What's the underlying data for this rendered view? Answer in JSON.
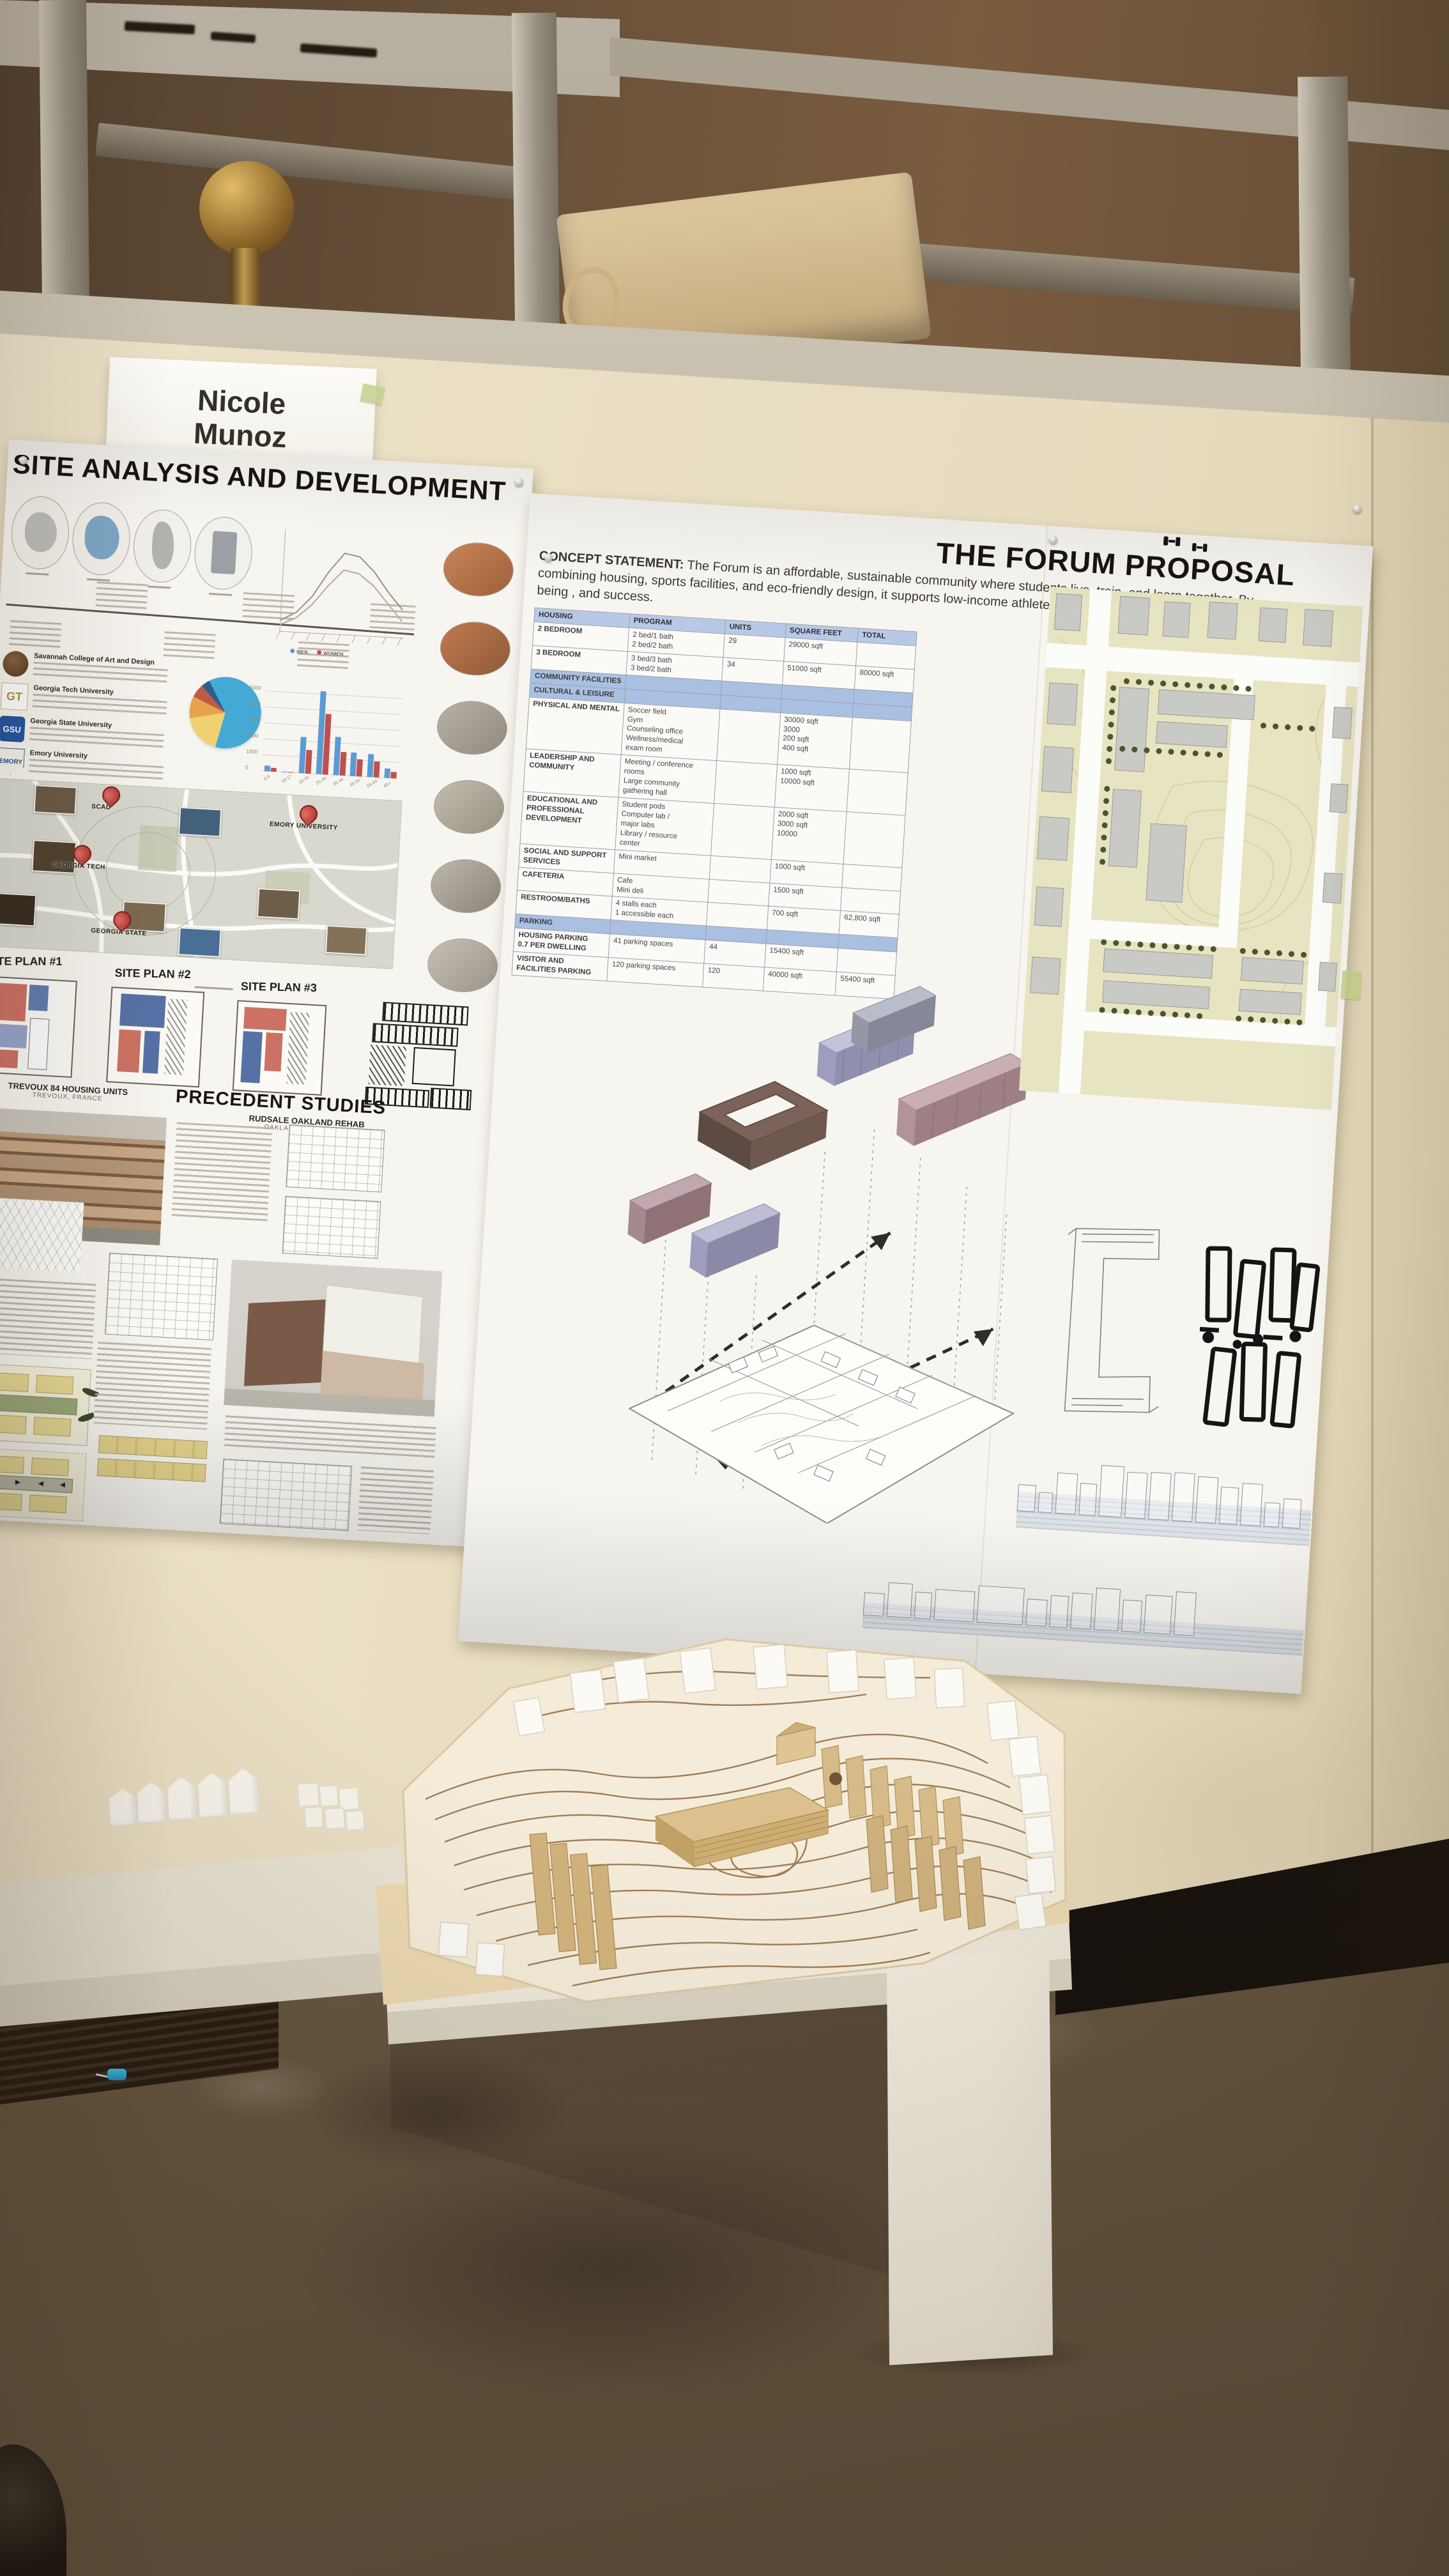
{
  "scene": {
    "name_card": {
      "name": "Nicole\nMunoz"
    }
  },
  "poster_left": {
    "title": "SITE ANALYSIS AND DEVELOPMENT",
    "universities": [
      {
        "abbr": "SCAD",
        "name": "Savannah College of Art and Design"
      },
      {
        "abbr": "GT",
        "name": "Georgia Tech University"
      },
      {
        "abbr": "GSU",
        "name": "Georgia State University"
      },
      {
        "abbr": "EMORY",
        "name": "Emory University"
      }
    ],
    "map_pins": [
      "SCAD",
      "GEORGIA TECH",
      "GEORGIA STATE",
      "EMORY UNIVERSITY"
    ],
    "sketch_labels": [
      "SITE PLAN #1",
      "SITE PLAN #2",
      "SITE PLAN #3"
    ],
    "precedent": {
      "heading": "PRECEDENT STUDIES",
      "study1": {
        "title": "TREVOUX 84 HOUSING UNITS",
        "subtitle": "TREVOUX, FRANCE"
      },
      "study2": {
        "title": "RUDSALE OAKLAND REHAB",
        "subtitle": "OAKLAND, CALIFORNIA"
      }
    }
  },
  "poster_right": {
    "title": "THE FORUM PROPOSAL",
    "concept_label": "CONCEPT STATEMENT:",
    "concept_text": "The Forum is an affordable, sustainable community where students live, train, and learn together. By combining housing, sports facilities, and eco-friendly design, it supports low-income athletes while fostering collaboration, well-being , and success.",
    "table": {
      "headers": [
        "HOUSING",
        "PROGRAM",
        "UNITS",
        "SQUARE FEET",
        "TOTAL"
      ],
      "rows": [
        {
          "cells": [
            "2 BEDROOM",
            "2 bed/1 bath\n2 bed/2 bath",
            "29",
            "29000 sqft",
            ""
          ]
        },
        {
          "cells": [
            "3 BEDROOM",
            "3 bed/3 bath\n3 bed/2 bath",
            "34",
            "51000 sqft",
            "80000 sqft"
          ]
        },
        {
          "kind": "section",
          "cells": [
            "COMMUNITY FACILITIES",
            "",
            "",
            "",
            ""
          ]
        },
        {
          "kind": "section",
          "cells": [
            "CULTURAL & LEISURE",
            "",
            "",
            "",
            ""
          ]
        },
        {
          "cells": [
            "PHYSICAL AND MENTAL",
            "Soccer field\nGym\nCounseling office\nWellness/medical\nexam room",
            "",
            "30000 sqft\n3000\n200 sqft\n400 sqft",
            ""
          ]
        },
        {
          "cells": [
            "LEADERSHIP AND COMMUNITY",
            "Meeting / conference\nrooms\nLarge community\ngathering hall",
            "",
            "1000 sqft\n10000 sqft",
            ""
          ]
        },
        {
          "cells": [
            "EDUCATIONAL AND PROFESSIONAL DEVELOPMENT",
            "Student pods\nComputer lab /\nmajor labs\nLibrary / resource\ncenter",
            "",
            "2000 sqft\n3000 sqft\n10000",
            ""
          ]
        },
        {
          "cells": [
            "SOCIAL AND SUPPORT SERVICES",
            "Mini market",
            "",
            "1000 sqft",
            ""
          ]
        },
        {
          "cells": [
            "CAFETERIA",
            "Cafe\nMini deli",
            "",
            "1500 sqft",
            ""
          ]
        },
        {
          "cells": [
            "RESTROOM/BATHS",
            "4 stalls each\n1 accessible each",
            "",
            "700 sqft",
            "62,800 sqft"
          ]
        },
        {
          "kind": "section",
          "cells": [
            "PARKING",
            "",
            "",
            "",
            ""
          ]
        },
        {
          "cells": [
            "HOUSING PARKING\n0.7 PER DWELLING",
            "41 parking spaces",
            "44",
            "15400 sqft",
            ""
          ]
        },
        {
          "cells": [
            "VISITOR AND\nFACILITIES PARKING",
            "120 parking spaces",
            "120",
            "40000 sqft",
            "55400 sqft"
          ]
        }
      ]
    }
  },
  "chart_data": [
    {
      "type": "bar",
      "title": "Atlanta age demographics (poster infographic)",
      "categories": [
        "0-9",
        "10-17",
        "18-24",
        "25-34",
        "35-44",
        "45-54",
        "55-64",
        "65+"
      ],
      "series": [
        {
          "name": "MEN",
          "color": "#5b9bd5",
          "values": [
            350,
            60,
            2300,
            5200,
            2400,
            1500,
            1450,
            600
          ]
        },
        {
          "name": "WOMEN",
          "color": "#c0504d",
          "values": [
            260,
            50,
            1500,
            3800,
            1500,
            1100,
            1000,
            400
          ]
        }
      ],
      "ylim": [
        0,
        6000
      ],
      "ytick_step": 1000,
      "grid": true,
      "legend_position": "top"
    },
    {
      "type": "pie",
      "title": "Population share (poster infographic, labels illegible)",
      "slices": [
        {
          "label": "slice-1",
          "value": 62,
          "color": "#45a9d6"
        },
        {
          "label": "slice-2",
          "value": 18,
          "color": "#f0d172"
        },
        {
          "label": "slice-3",
          "value": 10,
          "color": "#e8a14f"
        },
        {
          "label": "slice-4",
          "value": 6,
          "color": "#bf5a47"
        },
        {
          "label": "slice-5",
          "value": 4,
          "color": "#2e5f8a"
        }
      ]
    },
    {
      "type": "line",
      "title": "Paired trend curves (poster infographic, labels illegible)",
      "x": [
        1,
        2,
        3,
        4,
        5,
        6,
        7,
        8,
        9
      ],
      "series": [
        {
          "name": "curve-1",
          "color": "#9a958a",
          "values": [
            8,
            14,
            26,
            44,
            58,
            56,
            46,
            32,
            20
          ]
        },
        {
          "name": "curve-2",
          "color": "#b3aea3",
          "values": [
            5,
            10,
            20,
            34,
            46,
            44,
            36,
            24,
            12
          ]
        }
      ],
      "ylim": [
        0,
        70
      ]
    }
  ]
}
